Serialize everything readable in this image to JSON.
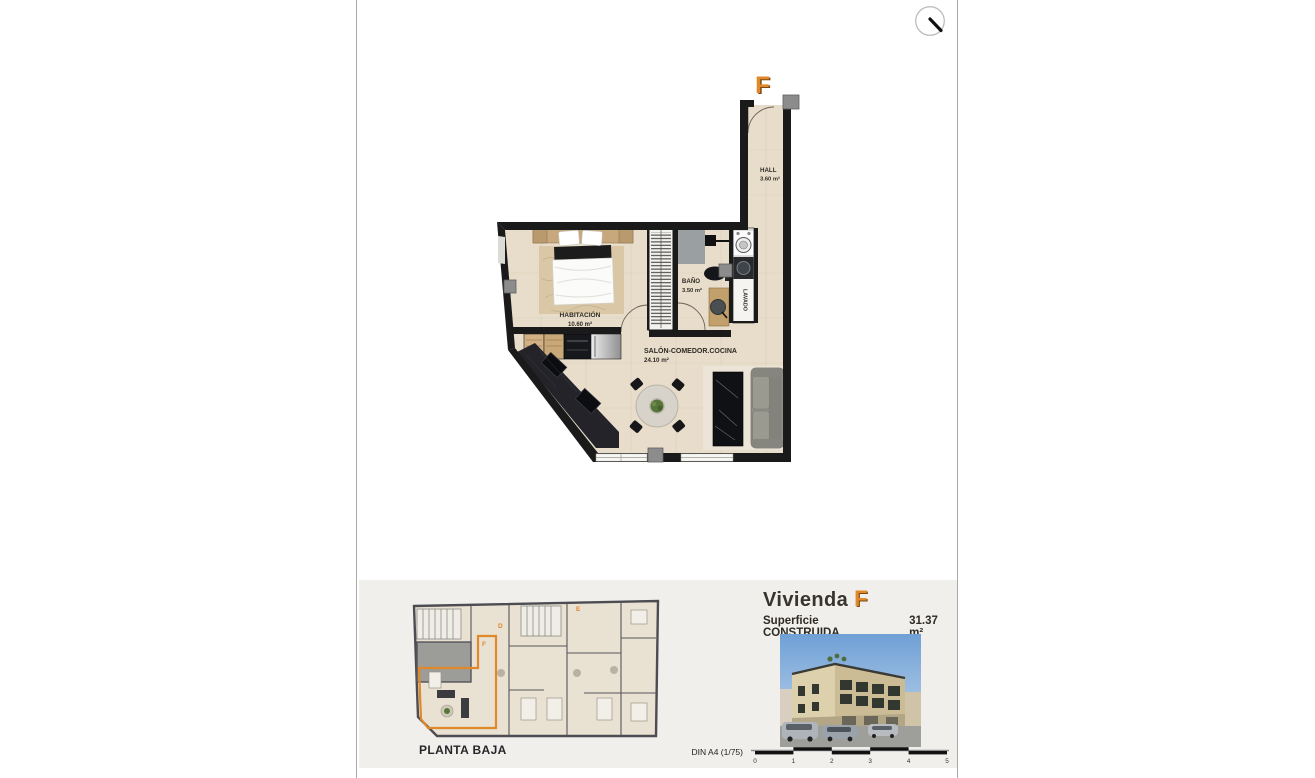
{
  "page": {
    "background": "#ffffff",
    "edge_line_color": "#a9a9a9",
    "footer_panel_background": "#f0efec"
  },
  "plan": {
    "unit_letter": "F",
    "accent_color": "#e0882a",
    "floor_color": "#e8ddca",
    "wall_color": "#1a1a1a",
    "rooms": {
      "hall": {
        "name": "HALL",
        "area": "3.60 m²"
      },
      "bedroom": {
        "name": "HABITACIÓN",
        "area": "10.60 m²"
      },
      "bathroom": {
        "name": "BAÑO",
        "area": "3.50 m²"
      },
      "living": {
        "name": "SALÓN-COMEDOR.COCINA",
        "area": "24.10 m²"
      },
      "laundry": {
        "name": "LAVADO"
      }
    }
  },
  "site_plan": {
    "caption": "PLANTA BAJA",
    "unit_labels": {
      "d": "D",
      "e": "E",
      "f": "F"
    }
  },
  "summary": {
    "title_prefix": "Vivienda",
    "unit_letter": "F",
    "surface_label": "Superficie CONSTRUIDA",
    "surface_value": "31.37 m²"
  },
  "sheet": {
    "format_label": "DIN A4 (1/75)",
    "scale_ticks": [
      "0",
      "1",
      "2",
      "3",
      "4",
      "5"
    ]
  }
}
